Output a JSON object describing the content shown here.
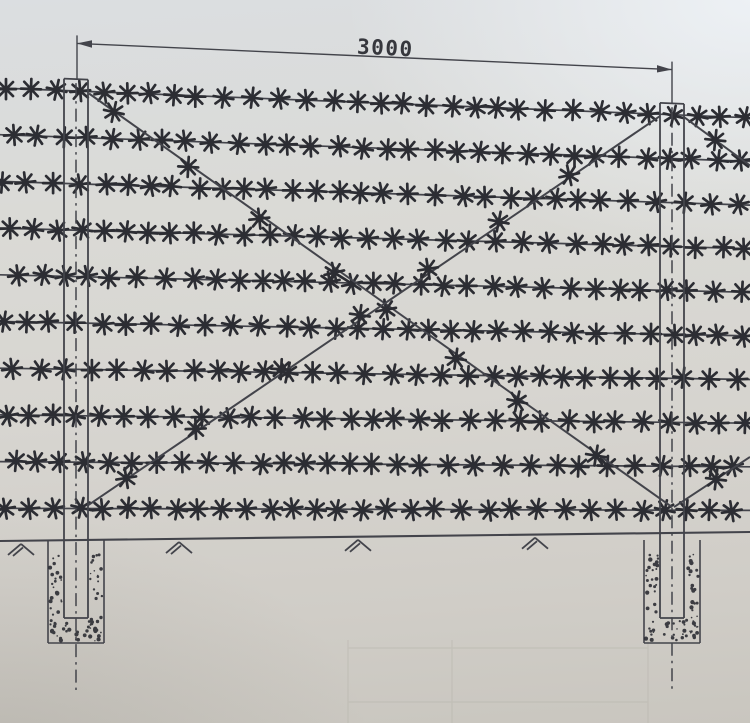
{
  "document": {
    "kind": "photographed technical drawing",
    "subject": "barbed-wire fence panel elevation with two embedded posts and X bracing"
  },
  "dimension": {
    "label": "3000"
  },
  "diagram": {
    "wire_row_count": 10,
    "post_count": 2,
    "brace_pattern": "X between post top and opposite post bottom, continuing into next panel",
    "ground_symbol_count": 4,
    "foundation": "posts set in stippled concrete pits below ground line"
  },
  "drawing": {
    "ink_color": "#43444b",
    "barb_color": "#2c2d33",
    "paper_light": "#dde0e3",
    "paper_dark": "#c9c6bf",
    "width": 750,
    "height": 723,
    "skew_k": 0.044,
    "skew_ground": 540,
    "skew_span": 500,
    "dim": {
      "y": 40,
      "x1": 77,
      "x2": 672,
      "ext_top": 32,
      "label_x": 385,
      "label_y": 55,
      "label_rot": 2.8
    },
    "wires": {
      "count": 10,
      "top": 88,
      "step": 46.7,
      "x1": 0,
      "x2": 750
    },
    "barbs": {
      "spacing": 24.5,
      "arm": 10
    },
    "posts": {
      "centers": [
        76,
        672
      ],
      "half_w": 12,
      "top": 76,
      "bottom": 618,
      "centerline_top": 80,
      "centerline_bottom": 690
    },
    "braces": [
      {
        "name": "brace-left-top-to-right-bottom",
        "x1": 89,
        "y1": 90,
        "x2": 672,
        "y2": 505,
        "stars": [
          0.05,
          0.17,
          0.3,
          0.42,
          0.5,
          0.62,
          0.74,
          0.87
        ]
      },
      {
        "name": "brace-left-bottom-to-right-top",
        "x1": 88,
        "y1": 505,
        "x2": 660,
        "y2": 90,
        "stars": [
          0.07,
          0.19,
          0.33,
          0.47,
          0.6,
          0.72,
          0.85
        ]
      },
      {
        "name": "brace-next-panel-upper",
        "x1": 684,
        "y1": 90,
        "x2": 750,
        "y2": 139,
        "stars": [
          0.48
        ]
      },
      {
        "name": "brace-next-panel-lower",
        "x1": 674,
        "y1": 505,
        "x2": 750,
        "y2": 451,
        "stars": [
          0.55
        ]
      }
    ],
    "ground": {
      "y_left": 541,
      "y_right": 532,
      "grass_x": [
        8,
        166,
        345,
        522
      ]
    },
    "pit": {
      "half_w": 28,
      "bottom": 643,
      "stipple_top": 553,
      "stipple_bottom": 641
    },
    "ghost_table": {
      "verticals": [
        348,
        452,
        648
      ],
      "horizontals": [
        648,
        702
      ],
      "x1": 348,
      "x2": 648,
      "y1": 640,
      "y2": 723
    }
  }
}
